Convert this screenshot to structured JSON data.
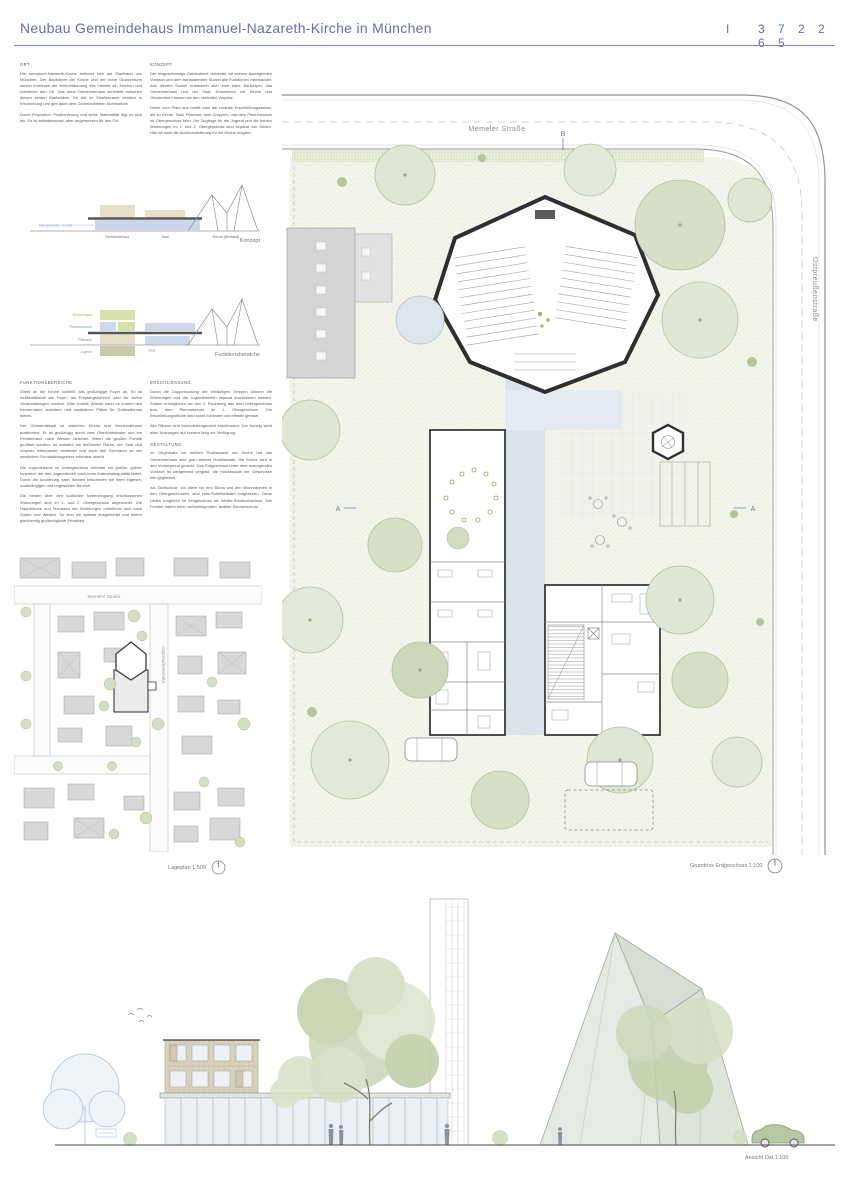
{
  "header": {
    "title": "Neubau Gemeindehaus Immanuel-Nazareth-Kirche in München",
    "separator": "I",
    "code": "3 7 2 2 6 5",
    "accent_color": "#5f6fb4"
  },
  "text_blocks": {
    "ort": {
      "heading": "ORT",
      "paragraphs": [
        "Die Immanuel-Nazareth-Kirche befindet sich am Stadtrand von München. Der Baukörper der Kirche und der hohe Glockenturm setzen innerhalb der Wohnbebauung des Viertels ein Zeichen und markieren den Ort. Das neue Gemeindehaus vermittelt zwischen diesen beiden Maßstäben. Es tritt im Straßenraum deutlich in Erscheinung und gibt auch dem Gemeindeleben Sichtbarkeit.",
        "Durch Proportion, Positionierung und seine Materialität fügt es sich ein. Es ist selbstbewusst, aber angemessen für den Ort."
      ]
    },
    "konzept": {
      "heading": "KONZEPT",
      "paragraphs": [
        "Der eingeschossige Gebäudeteil verbindet mit seinem ausragenden Vordach und dem transparenten Sockel alle Funktionen miteinander. Aus diesem Sockel entwickeln sich zwei klare Baukörper, das Gemeindehaus und der Saal. Zusammen mit Kirche und Glockenturm fassen sie den zentralen Vorplatz.",
        "Direkt vom Platz aus betritt man die zentrale Erschließungsachse, die zu Kirche, Saal, Pfarramt, dem Gruppen- und dem Plenumsraum im Obergeschoss führt. Die Zugänge für die Jugend und die beiden Wohnungen im 1. und 2. Obergeschoss sind separat von Süden. Hier ist auch die Außenanlieferung für die Küche möglich."
      ]
    },
    "funktionsbereiche": {
      "heading": "FUNKTIONSBEREICHE",
      "paragraphs": [
        "Direkt an die Kirche schließt das großzügige Foyer an. Es ist multifunktional als Foyer, als Empfangsbereich oder für kleine Veranstaltungen nutzbar. Über mobile Wände kann es zudem den Kirchenraum erweitern und zusätzliche Plätze für Gottesdienste bieten.",
        "Der Gemeindesaal ist zwischen Kirche und Gemeindehaus positioniert. Er ist großzügig durch zwei Oberlichtbänder und ein Fensterband nach Westen belichtet. Wenn die großen Portale geöffnet werden, so entsteht ein fließender Raum, der Saal und Vorplatz miteinander verbindet und auch den Grünraum an der westlichen Grundstücksgrenze erfahrbar macht.",
        "Die Jugendräume im Untergeschoss belichtet ein großer, grüner Innenhof, der den Jugendlichen auch hohe Aufenthaltsqualität bietet. Durch die Anordnung nach Westen bekommen sie ihren eigenen, unabhängigen und ungestörten Bereich.",
        "Die beiden über den südlichen Nebeneingang erschlossenen Wohnungen sind im 1. und 2. Obergeschoss angeordnet. Die Haupträume und Terrassen der Wohnungen orientieren sich nach Süden und Westen. So sind sie optimal ausgerichtet und bieten gleichzeitig größtmögliche Privatheit."
      ]
    },
    "erschliessung": {
      "heading": "ERSCHLIESSUNG",
      "paragraphs": [
        "Durch die Doppelnutzung der einläufigen Treppen können die Wohnungen und der Jugendbereich separat erschlossen werden. Zudem ermöglichen sie den 2. Fluchtweg aus dem Untergeschoss bzw. dem Plenumsraum im 1. Obergeschoss. Die Erschließungsfläche wird somit minimiert und effektiv genutzt.",
        "Alle Räume sind behindertengerecht erschlossen. Der Aufzug steht allen Nutzungen auf kurzem Weg zur Verfügung."
      ]
    },
    "gestaltung": {
      "heading": "GESTALTUNG",
      "paragraphs": [
        "Im Gegensatz zur weißen Putzfassade der Kirche hat das Gemeindehaus eine grau lasierte Holzfassade. Die Kirche wird in den Vordergrund gerückt. Das Erdgeschoss unter dem ausragenden Vordach ist weitgehend verglast, die Holzfassade der Geschosse fein gegliedert.",
        "Als Sichtschutz, vor allem vor den Büros und den Wohnräumen in den Obergeschossen, sind Holz-Schiebeläden vorgesehen. Diese Läden fungieren im Erdgeschoss als Wetter-/Einbruchschutz. Alle Fenster haben einen außenliegenden, textilen Sonnenschutz."
      ]
    }
  },
  "diagram_konzept": {
    "caption": "Konzept",
    "label_sockel": "transparenter Sockel",
    "label_gemeindehaus": "Gemeindehaus",
    "label_saal": "Saal",
    "label_kirche": "Kirche (Bestand)"
  },
  "diagram_funktionen": {
    "caption": "Funktionsbereiche",
    "labels": [
      "Wohnungen",
      "Plenumsraum",
      "Pfarramt",
      "Jugend"
    ],
    "label_saal": "Saal",
    "colors": {
      "wohnungen": "#d6e0a8",
      "plenum": "#ccd8ec",
      "pfarramt": "#e6ddc4",
      "jugend": "#c9c9ab"
    }
  },
  "lageplan": {
    "caption": "Lageplan 1:500",
    "street_top": "Memeler Straße",
    "street_right": "Ostpreußenstraße"
  },
  "grundriss": {
    "caption": "Grundriss Erdgeschoss 1:100",
    "street_top": "Memeler Straße",
    "street_right": "Ostpreußenstraße",
    "marker_b": "B",
    "marker_a_left": "A",
    "marker_a_right": "A"
  },
  "ansicht": {
    "caption": "Ansicht Ost 1:100"
  },
  "palette": {
    "accent_blue": "#5f6fb4",
    "lawn": "#f2f5ea",
    "tree_light": "#dfe6d3",
    "tree_mid": "#d7e0c6",
    "wall_dark": "#2f2f2f",
    "floor_blue": "#dbe2ec",
    "wood_beige": "#d8d1bd",
    "glass": "#eaf0f4"
  }
}
